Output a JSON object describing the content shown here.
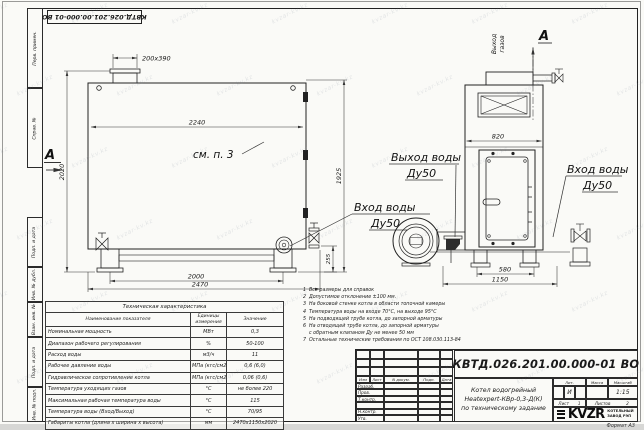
{
  "watermark": {
    "text": "kvzar-kv.kz"
  },
  "frame": {
    "doc_number_top": "КВТД.026.201.00.000-01 ВО",
    "margin_labels": [
      "Перв. примен.",
      "Справ. №",
      "Подп. и дата",
      "Инв. № дубл.",
      "Взам. инв. №",
      "Подп. и дата",
      "Инв. № подл."
    ],
    "format_note": "Формат  А3"
  },
  "drawing": {
    "left_view": {
      "chimney": "200x390",
      "top_width": "2240",
      "h_left": "2020",
      "h_right": "1925",
      "nozzle": "255",
      "base_inner": "2000",
      "base_outer": "2470",
      "see_note": "см. п. 3",
      "section": "А",
      "inlet1": "Вход воды",
      "inlet2": "Ду50"
    },
    "right_view": {
      "section": "А",
      "gas1": "Выход",
      "gas2": "газов",
      "width": "820",
      "base_inner": "580",
      "base_outer": "1150",
      "outlet1": "Выход воды",
      "outlet2": "Ду50",
      "inlet1": "Вход воды",
      "inlet2": "Ду50"
    }
  },
  "tech_table": {
    "title": "Техническая характеристика",
    "headers": [
      "Наименование показателя",
      "Единицы измерения",
      "Значение"
    ],
    "rows": [
      [
        "Номинальная мощность",
        "МВт",
        "0,3"
      ],
      [
        "Диапазон рабочего регулирования",
        "%",
        "50-100"
      ],
      [
        "Расход воды",
        "м3/ч",
        "11"
      ],
      [
        "Рабочее давление воды",
        "МПа (кгс/см2)",
        "0,6 (6,0)"
      ],
      [
        "Гидравлическое сопротивление котла",
        "МПа (кгс/см2)",
        "0,06 (0,6)"
      ],
      [
        "Температура уходящих газов",
        "°С",
        "не более 220"
      ],
      [
        "Максимальная рабочая температура воды",
        "°С",
        "115"
      ],
      [
        "Температура воды (Вход/Выход)",
        "°С",
        "70/95"
      ],
      [
        "Габариты котла (длина х ширина х высота)",
        "мм",
        "2470х1150х2020"
      ]
    ]
  },
  "notes": {
    "items": [
      {
        "n": "1",
        "text": "Все размеры для справок"
      },
      {
        "n": "2",
        "text": "Допустимое отклонение ±100 мм."
      },
      {
        "n": "3",
        "text": "На боковой стенке котла в области топочной камеры"
      },
      {
        "n": "4",
        "text": "Температура воды на входе 70°С, на выходе 95°С"
      },
      {
        "n": "5",
        "text": "На подводящей трубе котла, до запорной арматуры"
      },
      {
        "n": "6",
        "text": "На отводящей трубе котла, до запорной арматуры"
      },
      {
        "n": "",
        "text": "с обратным клапаном Ду не менее 50 мм"
      },
      {
        "n": "7",
        "text": "Остальные технические требования по ОСТ 108.030.113-84"
      }
    ]
  },
  "title_block": {
    "doc_number": "КВТД.026.201.00.000-01 ВО",
    "product_line1": "Котел водогрейный",
    "product_line2": "Heatexpert-КВр-0,3-Д(К)",
    "product_line3": "по техническому задание",
    "cols": {
      "izm": "Изм",
      "list": "Лист",
      "doc": "N докум.",
      "sign": "Подп.",
      "date": "Дата"
    },
    "sig_rows": [
      "Разраб.",
      "Пров.",
      "Т.контр.",
      "",
      "Н.контр.",
      "Утв."
    ],
    "lit_header": "Лит.",
    "mass_header": "Масса",
    "scale_header": "Масштаб",
    "lit_value": "И",
    "scale_value": "1:15",
    "sheet_label": "Лист",
    "sheet_value": "1",
    "sheets_label": "Листов",
    "sheets_value": "2",
    "logo": "KVZR",
    "company_line1": "КОТЕЛЬНЫЙ",
    "company_line2": "ЗАВОД РЭП"
  }
}
